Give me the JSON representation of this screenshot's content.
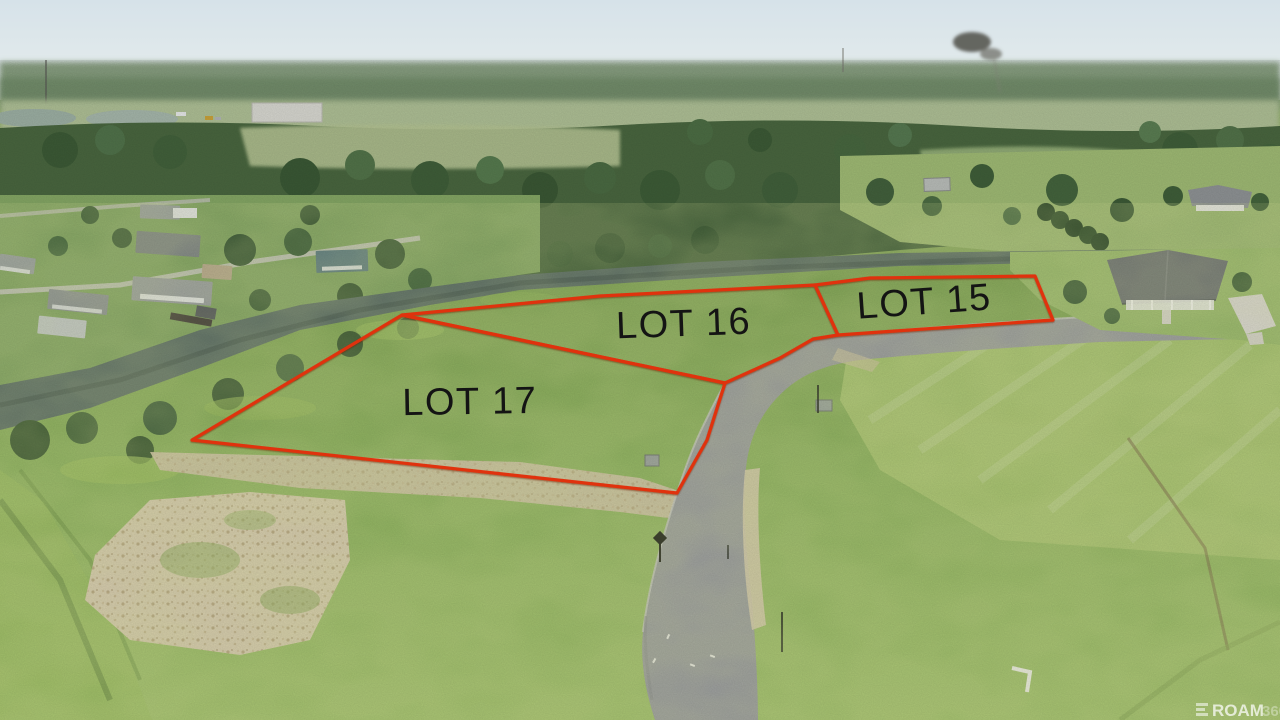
{
  "photo": {
    "outline_color": "#e0320e",
    "label_color": "#141414",
    "lots": [
      {
        "id": "lot-15",
        "label": "LOT 15",
        "points": "815,285 870,278 1035,276 1053,320 838,335",
        "label_x": 925,
        "label_y": 314,
        "label_transform": "rotate(-4 925 314)"
      },
      {
        "id": "lot-16",
        "label": "LOT 16",
        "points": "402,315 600,296 815,285 838,335 813,339 780,358 725,383",
        "label_x": 684,
        "label_y": 336,
        "label_transform": "rotate(-2 684 336)"
      },
      {
        "id": "lot-17",
        "label": "LOT 17",
        "points": "402,315 725,383 707,440 677,493 192,440",
        "label_x": 470,
        "label_y": 414,
        "label_transform": "rotate(-1 470 414)"
      }
    ],
    "watermark": {
      "icon": "grid-icon",
      "text": "ROAM",
      "suffix": "360"
    }
  }
}
